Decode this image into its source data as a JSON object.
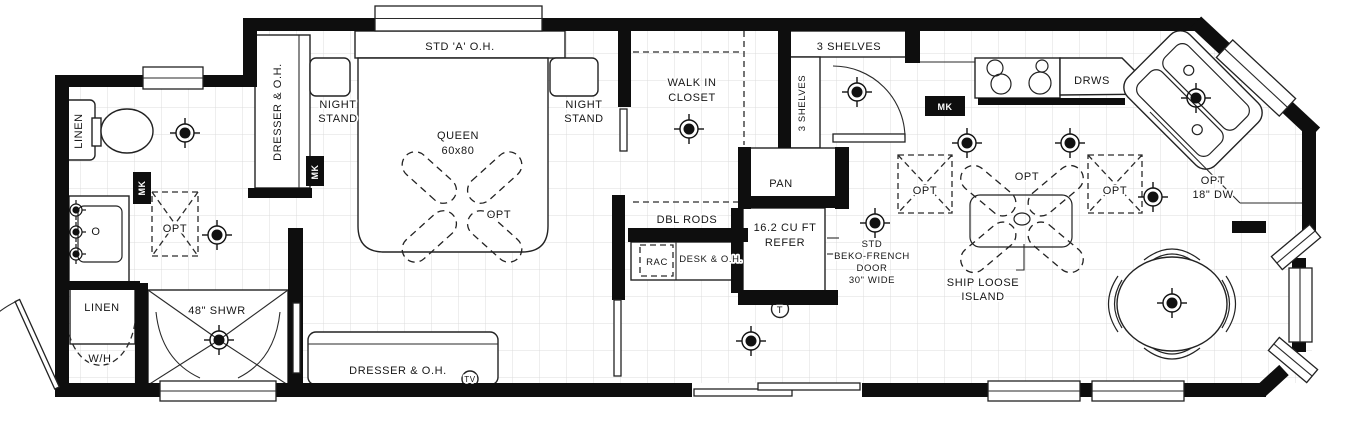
{
  "bathroom": {
    "linen_cabinet": "LINEN",
    "faucet": "O",
    "optional_box": "OPT",
    "vent_marker": "MK",
    "linen_closet": "LINEN",
    "water_heater": "W/H",
    "shower": "48\" SHWR"
  },
  "bedroom": {
    "dresser_left": "DRESSER & O.H.",
    "night_stand_left_line1": "NIGHT",
    "night_stand_left_line2": "STAND",
    "overhead_cabinet": "STD 'A' O.H.",
    "bed_line1": "QUEEN",
    "bed_line2": "60x80",
    "fan_option": "OPT",
    "vent_marker": "MK",
    "night_stand_right_line1": "NIGHT",
    "night_stand_right_line2": "STAND",
    "dresser_bottom": "DRESSER & O.H.",
    "tv": "TV"
  },
  "closet": {
    "title_line1": "WALK IN",
    "title_line2": "CLOSET",
    "rods": "DBL RODS",
    "rac": "RAC",
    "desk": "DESK & O.H."
  },
  "hall": {
    "shelves_top": "3 SHELVES",
    "shelves_side": "3 SHELVES",
    "pantry": "PAN"
  },
  "kitchen": {
    "refrigerator_line1": "16.2 CU FT",
    "refrigerator_line2": "REFER",
    "thermostat": "T",
    "refrigerator_note_line1": "STD",
    "refrigerator_note_line2": "BEKO-FRENCH",
    "refrigerator_note_line3": "DOOR",
    "refrigerator_note_line4": "30\" WIDE",
    "vent_marker": "MK",
    "optional_left": "OPT",
    "optional_island": "OPT",
    "optional_right": "OPT",
    "island_line1": "SHIP LOOSE",
    "island_line2": "ISLAND",
    "drawers": "DRWS",
    "dishwasher_line1": "OPT",
    "dishwasher_line2": "18\" DW"
  }
}
